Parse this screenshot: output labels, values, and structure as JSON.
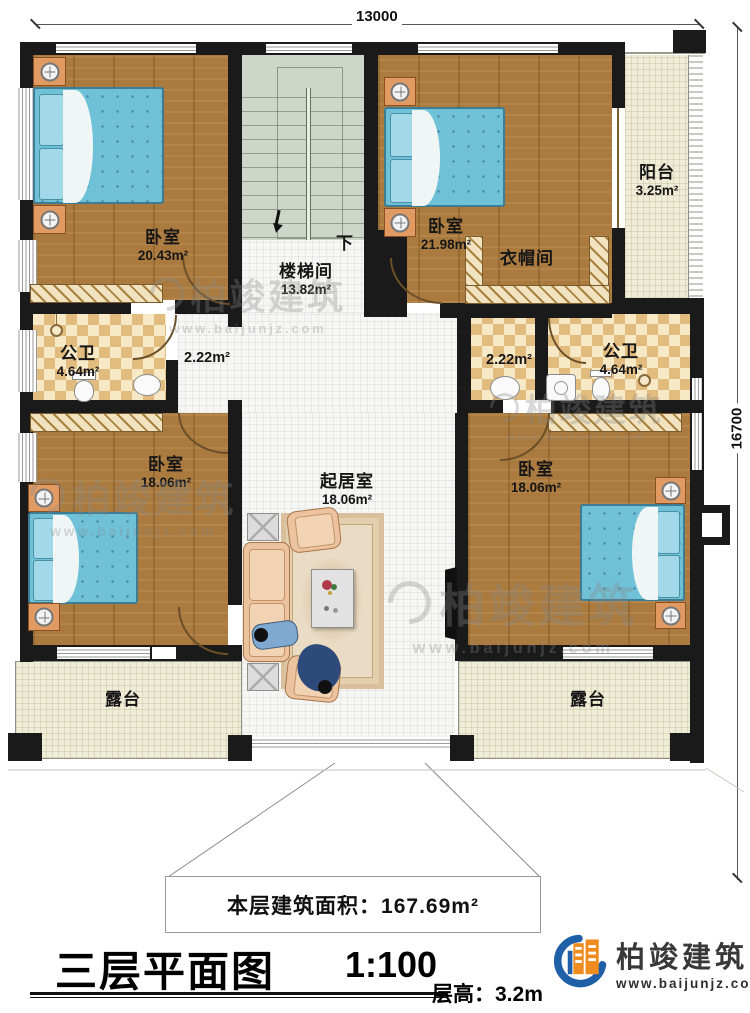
{
  "dimensions": {
    "width_label": "13000",
    "height_label": "16700"
  },
  "rooms": [
    {
      "name": "卧室",
      "area": "20.43m²"
    },
    {
      "name": "楼梯间",
      "area": "13.82m²"
    },
    {
      "name": "卧室",
      "area": "21.98m²"
    },
    {
      "name": "衣帽间"
    },
    {
      "name": "阳台",
      "area": "3.25m²"
    },
    {
      "name": "公卫",
      "area": "4.64m²"
    },
    {
      "area": "2.22m²"
    },
    {
      "area": "2.22m²"
    },
    {
      "name": "公卫",
      "area": "4.64m²"
    },
    {
      "name": "起居室",
      "area": "18.06m²"
    },
    {
      "name": "卧室",
      "area": "18.06m²"
    },
    {
      "name": "卧室",
      "area": "18.06m²"
    },
    {
      "name": "露台"
    },
    {
      "name": "露台"
    }
  ],
  "stairs": {
    "direction_label": "下"
  },
  "footer": {
    "floor_area": "本层建筑面积：167.69m²",
    "title": "三层平面图",
    "scale": "1:100",
    "floor_height": "层高：3.2m"
  },
  "branding": {
    "company": "柏竣建筑",
    "website": "www.baijunjz.com"
  },
  "watermark": {
    "company": "柏竣建筑",
    "website": "www.baijunjz.com"
  }
}
